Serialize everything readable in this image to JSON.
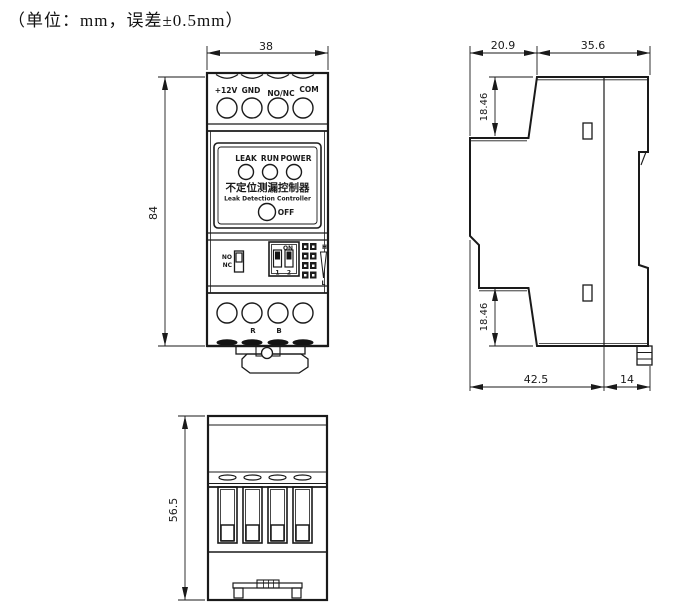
{
  "title": "（单位：mm，误差±0.5mm）",
  "front_view": {
    "dims": {
      "width": "38",
      "height": "84"
    },
    "top_terminals": [
      "+12V",
      "GND",
      "NO/NC",
      "COM"
    ],
    "leds": [
      "LEAK",
      "RUN",
      "POWER"
    ],
    "device_name_cn": "不定位测漏控制器",
    "device_name_en": "Leak Detection Controller",
    "off_button": "OFF",
    "relay_switch": {
      "no": "NO",
      "nc": "NC"
    },
    "dip_switch": {
      "label": "ON",
      "pos1": "1",
      "pos2": "2"
    },
    "sensitivity": {
      "high": "H",
      "low": "L"
    },
    "bottom_terminals": {
      "r": "R",
      "b": "B"
    }
  },
  "side_view": {
    "dims": {
      "top_left": "20.9",
      "top_right": "35.6",
      "upper_step": "18.46",
      "lower_step": "18.46",
      "bottom_body": "42.5",
      "bottom_rail": "14"
    }
  },
  "bottom_view": {
    "dims": {
      "height": "56.5"
    }
  },
  "colors": {
    "line": "#1a1a1a",
    "h_label": "#993333",
    "l_label": "#335599"
  }
}
